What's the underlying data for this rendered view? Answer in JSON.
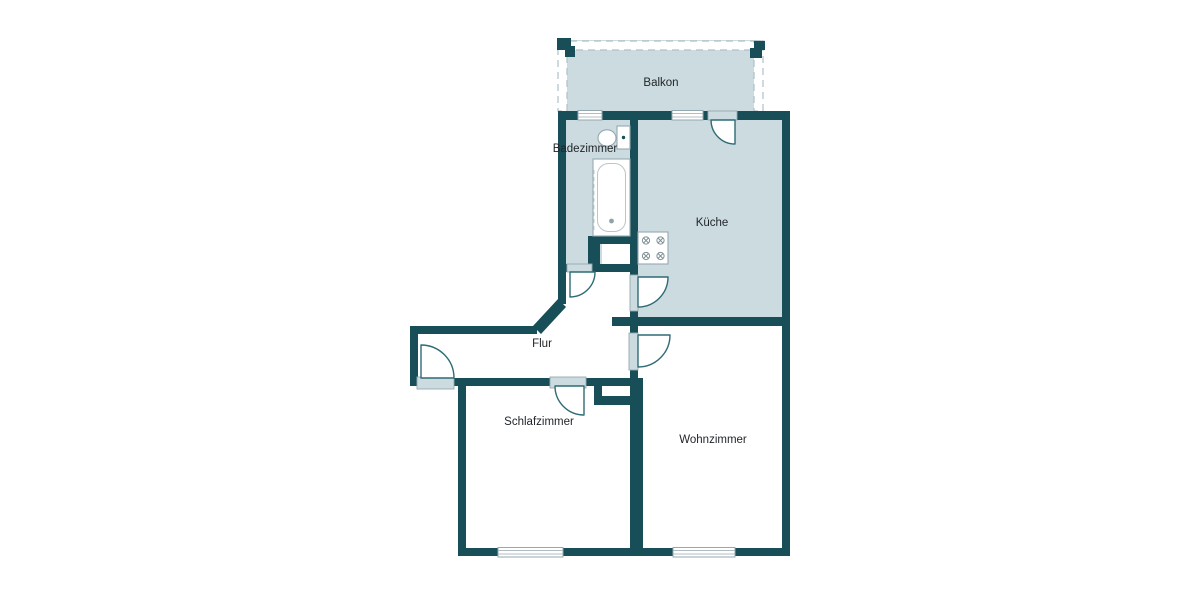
{
  "plan": {
    "kind": "apartment-floor-plan"
  },
  "rooms": {
    "balkon": {
      "label": "Balkon"
    },
    "badezimmer": {
      "label": "Badezimmer"
    },
    "kueche": {
      "label": "Küche"
    },
    "flur": {
      "label": "Flur"
    },
    "schlafzimmer": {
      "label": "Schlafzimmer"
    },
    "wohnzimmer": {
      "label": "Wohnzimmer"
    }
  },
  "fixtures": [
    "bathtub",
    "toilet",
    "stove"
  ],
  "colors": {
    "wall": "#174E58",
    "room_fill": "#CBDBDF",
    "floor": "#FFFFFF",
    "door_arc": "#2E6B75",
    "window_frame": "#96A9B0",
    "railing_dash": "#AEC1C7",
    "text": "#1F2328"
  }
}
